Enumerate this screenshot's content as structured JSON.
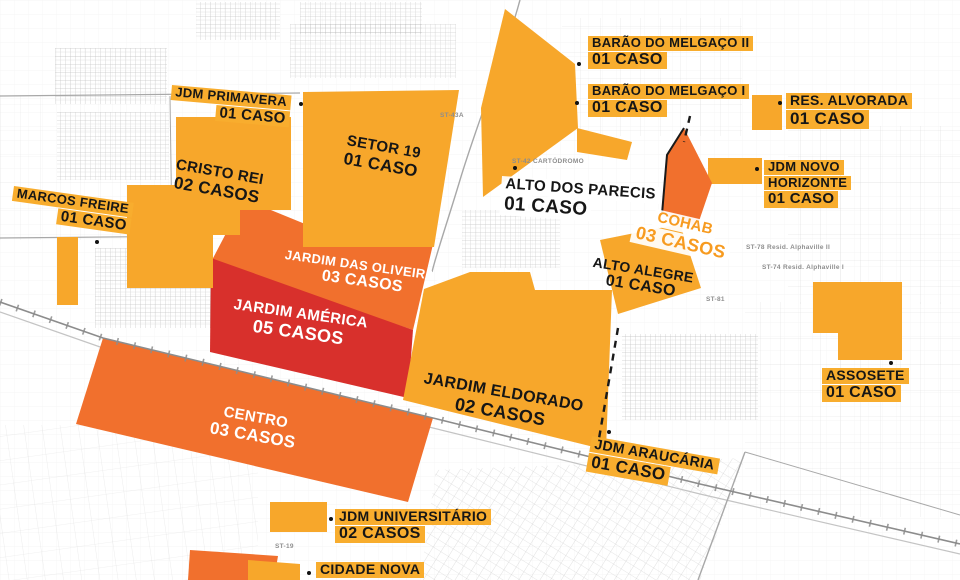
{
  "colors": {
    "yellow": "#F7A72B",
    "orange": "#F1702D",
    "red": "#D8302C",
    "label_yellow_bg": "#F8AD2E",
    "cohab_text": "#F79B20",
    "ink": "#161616",
    "white_text": "#FFFFFF",
    "map_line": "#A8A8A8"
  },
  "labels": [
    {
      "id": "barao-do-melgaco-ii",
      "line1": "BARÃO DO MELGAÇO II",
      "line2": "01 CASO"
    },
    {
      "id": "barao-do-melgaco-i",
      "line1": "BARÃO DO MELGAÇO I",
      "line2": "01 CASO"
    },
    {
      "id": "res-alvorada",
      "line1": "RES. ALVORADA",
      "line2": "01 CASO"
    },
    {
      "id": "jdm-primavera",
      "line1": "JDM PRIMAVERA",
      "line2": "01 CASO"
    },
    {
      "id": "setor-19",
      "line1": "SETOR 19",
      "line2": "01 CASO"
    },
    {
      "id": "cristo-rei",
      "line1": "CRISTO REI",
      "line2": "02 CASOS"
    },
    {
      "id": "marcos-freire",
      "line1": "MARCOS FREIRE",
      "line2": "01 CASO"
    },
    {
      "id": "alto-dos-parecis",
      "line1": "ALTO DOS PARECIS",
      "line2": "01 CASO"
    },
    {
      "id": "cohab",
      "line1": "COHAB",
      "line2": "03 CASOS"
    },
    {
      "id": "jdm-novo-horizonte",
      "line1": "JDM NOVO",
      "line2": "HORIZONTE",
      "line3": "01 CASO"
    },
    {
      "id": "alto-alegre",
      "line1": "ALTO ALEGRE",
      "line2": "01 CASO"
    },
    {
      "id": "jardim-das-oliveiras",
      "line1": "JARDIM DAS OLIVEIRAS",
      "line2": "03 CASOS"
    },
    {
      "id": "jardim-america",
      "line1": "JARDIM AMÉRICA",
      "line2": "05 CASOS"
    },
    {
      "id": "jardim-eldorado",
      "line1": "JARDIM ELDORADO",
      "line2": "02 CASOS"
    },
    {
      "id": "assosete",
      "line1": "ASSOSETE",
      "line2": "01 CASO"
    },
    {
      "id": "centro",
      "line1": "CENTRO",
      "line2": "03 CASOS"
    },
    {
      "id": "jdm-araucaria",
      "line1": "JDM ARAUCÁRIA",
      "line2": "01 CASO"
    },
    {
      "id": "jdm-universitario",
      "line1": "JDM UNIVERSITÁRIO",
      "line2": "02 CASOS"
    },
    {
      "id": "cidade-nova",
      "line1": "CIDADE NOVA"
    }
  ],
  "map_texts": [
    {
      "text": "ST-42 CARTÓDROMO"
    },
    {
      "text": "PQ EXPOSIÇÕES"
    },
    {
      "text": "ST-78 Resid. Alphaville II"
    },
    {
      "text": "ST-74 Resid. Alphaville I"
    },
    {
      "text": "ST-81"
    },
    {
      "text": "ST-19"
    },
    {
      "text": "ST-43A"
    }
  ]
}
